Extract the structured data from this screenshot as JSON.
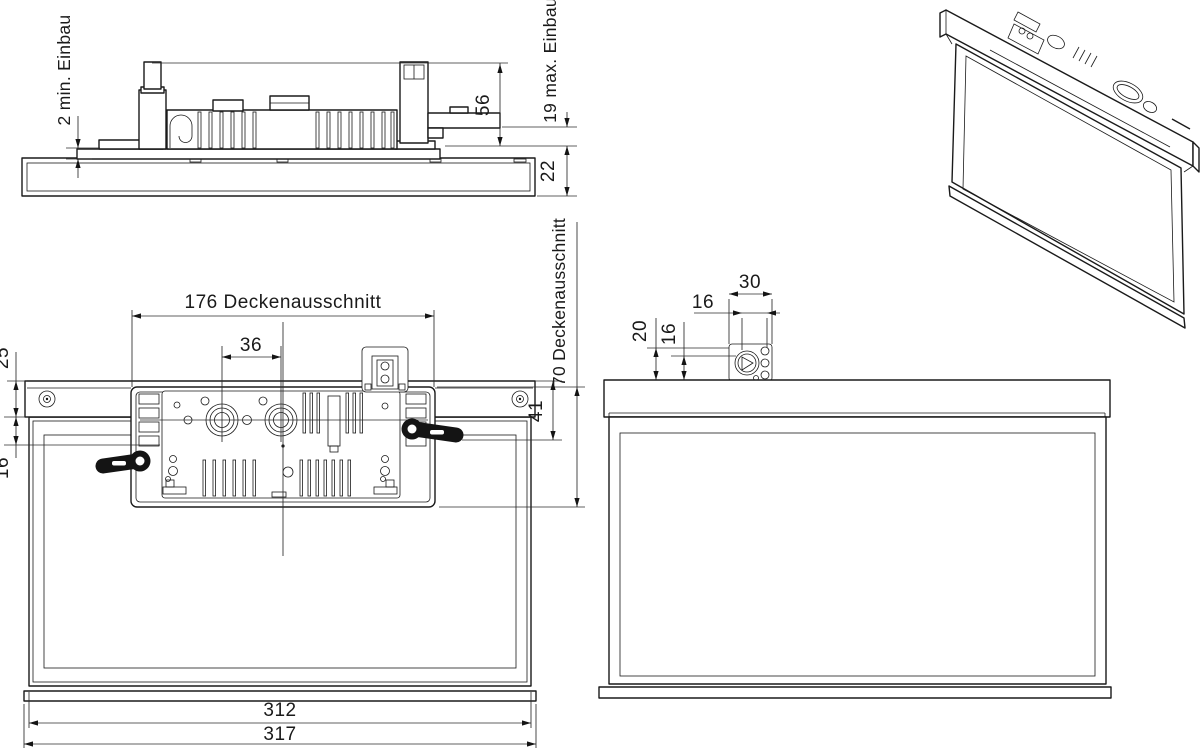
{
  "drawing": {
    "language": "de",
    "views": {
      "side": "side-section-view",
      "plan": "rear-plan-view",
      "front": "front-view",
      "iso": "isometric-view"
    }
  },
  "dims": {
    "side": {
      "min_einbau": "2 min. Einbau",
      "h56": "56",
      "max_einbau": "19 max. Einbau",
      "h22": "22"
    },
    "plan": {
      "cutout_w": "176 Deckenausschnitt",
      "gland": "36",
      "d25": "25",
      "d16": "16",
      "d41": "41",
      "cutout_h": "70 Deckenausschnitt",
      "w312": "312",
      "w317": "317"
    },
    "front": {
      "d30": "30",
      "d16h": "16",
      "d20": "20",
      "d16v": "16"
    }
  }
}
